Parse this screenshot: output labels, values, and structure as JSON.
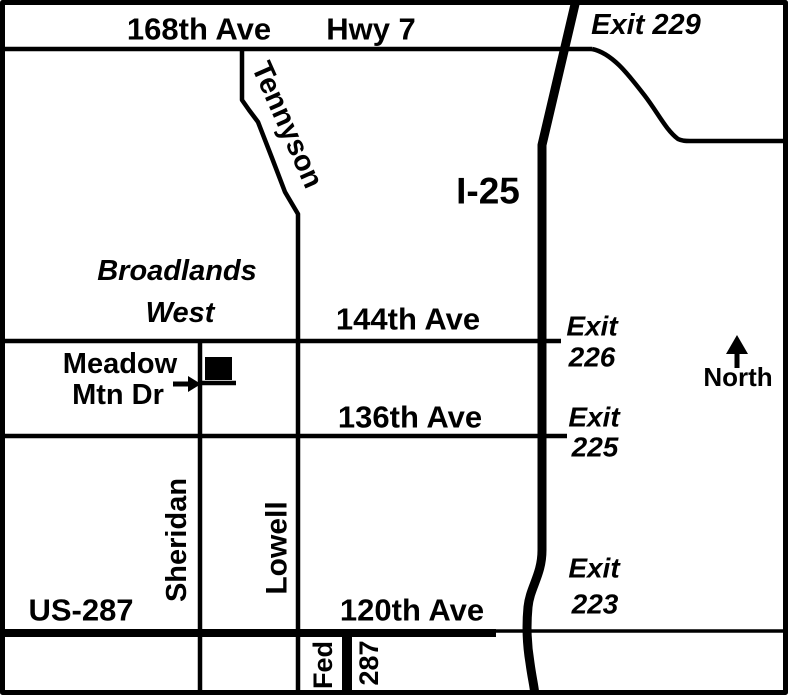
{
  "map": {
    "colors": {
      "road": "#000000",
      "background": "#ffffff"
    },
    "labels": {
      "ave168": "168th Ave",
      "hwy7": "Hwy 7",
      "exit229": "Exit 229",
      "tennyson": "Tennyson",
      "i25": "I-25",
      "broadlands_line1": "Broadlands",
      "broadlands_line2": "West",
      "ave144": "144th Ave",
      "exit226_line1": "Exit",
      "exit226_line2": "226",
      "north": "North",
      "meadow_line1": "Meadow",
      "meadow_line2": "Mtn Dr",
      "ave136": "136th Ave",
      "exit225_line1": "Exit",
      "exit225_line2": "225",
      "sheridan": "Sheridan",
      "lowell": "Lowell",
      "exit223_line1": "Exit",
      "exit223_line2": "223",
      "us287": "US-287",
      "ave120": "120th Ave",
      "fed": "Fed",
      "hwy287": "287"
    }
  }
}
